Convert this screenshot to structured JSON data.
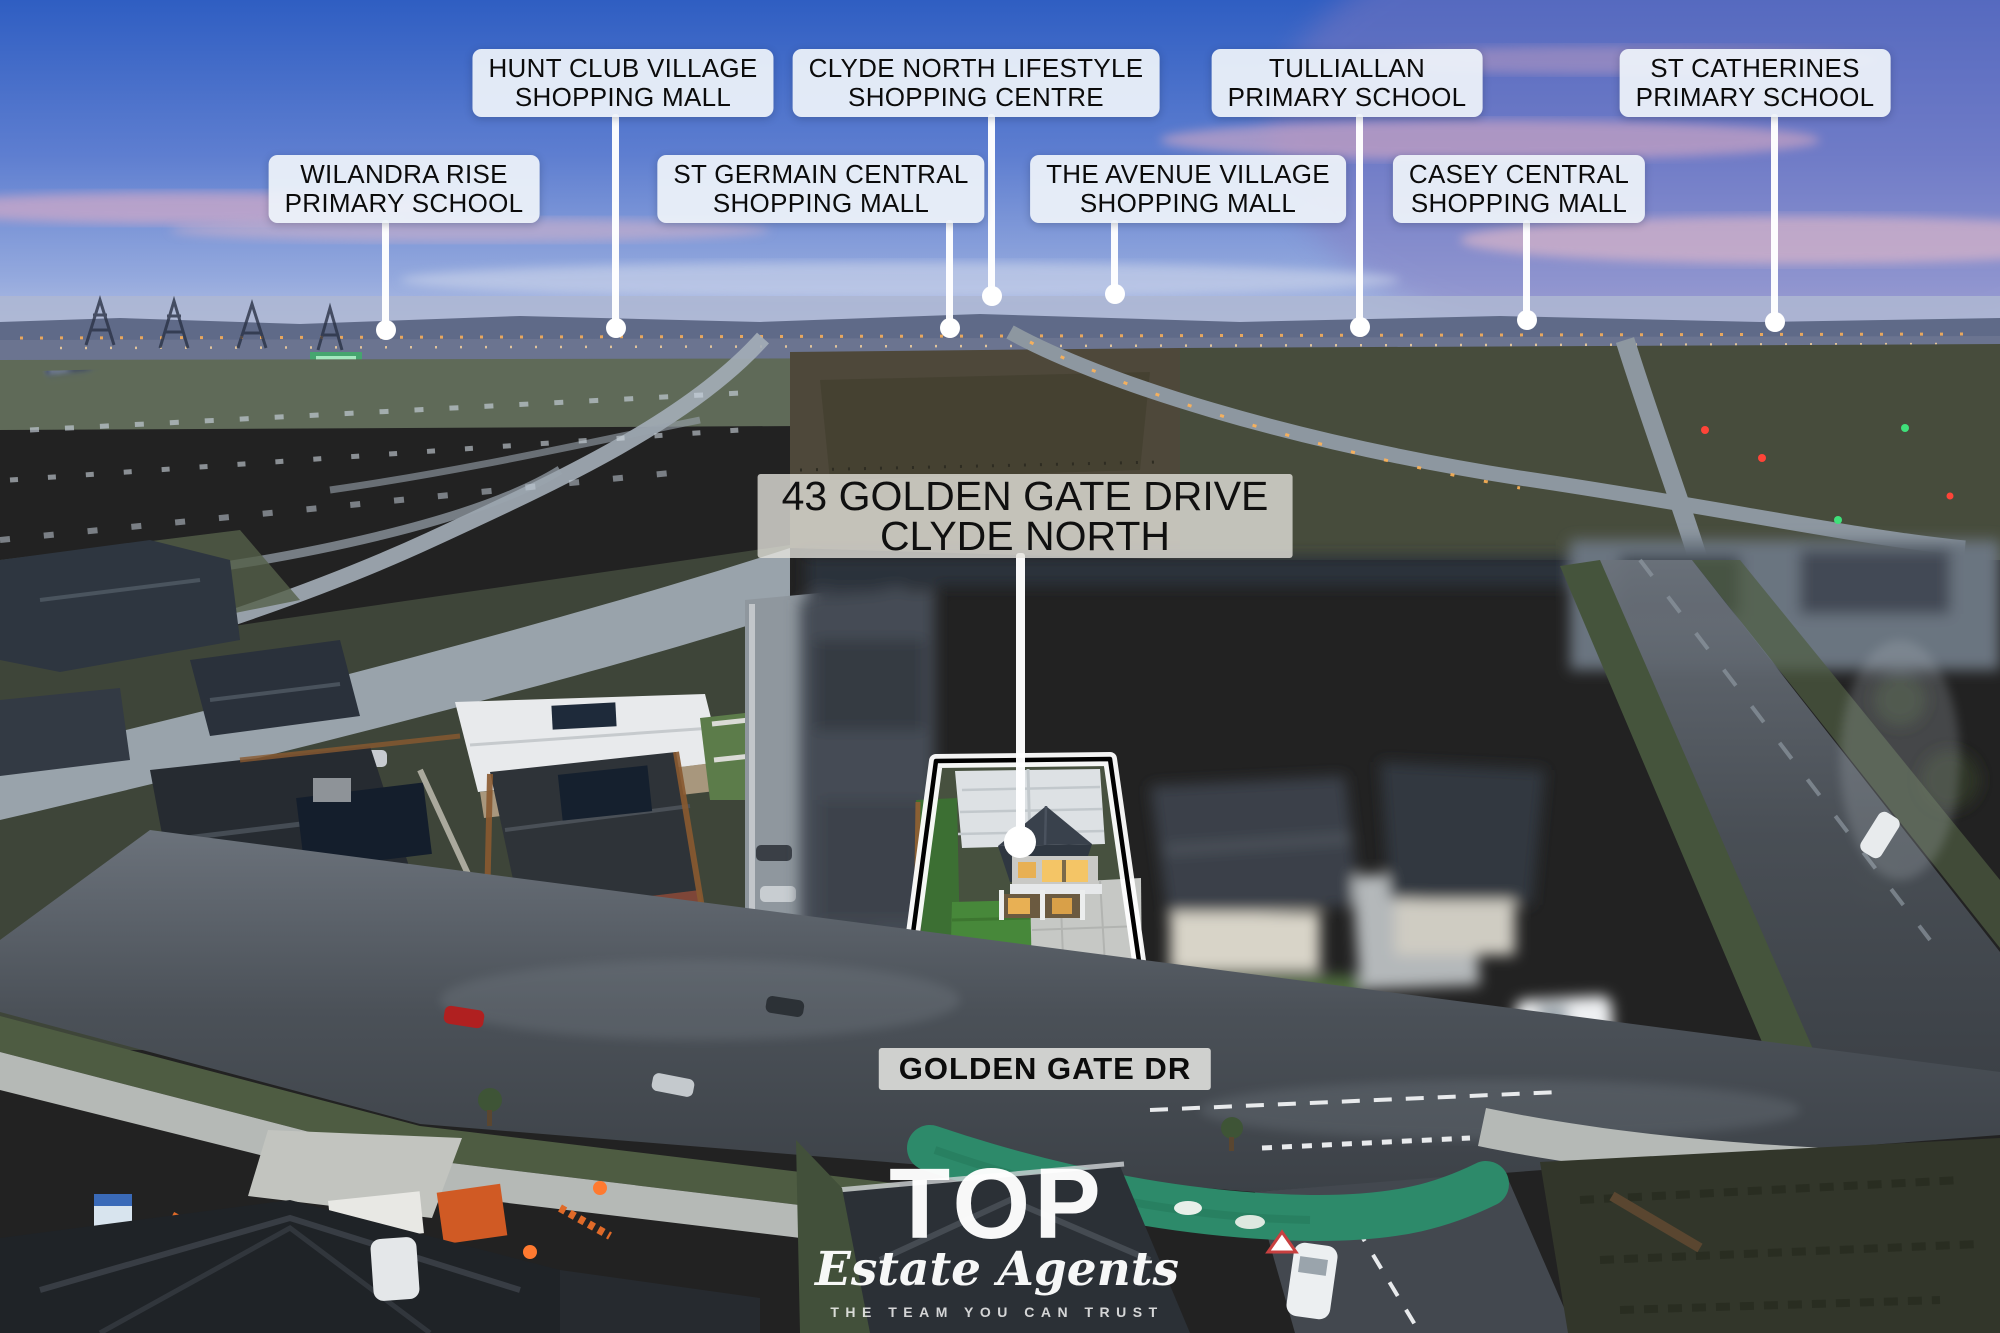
{
  "callouts": [
    {
      "name": "hunt-club-village",
      "line1": "HUNT CLUB VILLAGE",
      "line2": "SHOPPING MALL"
    },
    {
      "name": "clyde-north-lifestyle",
      "line1": "CLYDE NORTH LIFESTYLE",
      "line2": "SHOPPING CENTRE"
    },
    {
      "name": "tulliallan",
      "line1": "TULLIALLAN",
      "line2": "PRIMARY SCHOOL"
    },
    {
      "name": "st-catherines",
      "line1": "ST CATHERINES",
      "line2": "PRIMARY SCHOOL"
    },
    {
      "name": "wilandra-rise",
      "line1": "WILANDRA RISE",
      "line2": "PRIMARY SCHOOL"
    },
    {
      "name": "st-germain-central",
      "line1": "ST GERMAIN CENTRAL",
      "line2": "SHOPPING MALL"
    },
    {
      "name": "the-avenue-village",
      "line1": "THE AVENUE VILLAGE",
      "line2": "SHOPPING MALL"
    },
    {
      "name": "casey-central",
      "line1": "CASEY CENTRAL",
      "line2": "SHOPPING MALL"
    }
  ],
  "property_label": {
    "line1": "43 GOLDEN GATE DRIVE",
    "line2": "CLYDE NORTH"
  },
  "street_label": {
    "text": "GOLDEN GATE DR"
  },
  "logo": {
    "brand": "TOP",
    "script": "Estate Agents",
    "tagline": "THE TEAM YOU CAN TRUST"
  },
  "colors": {
    "label_bg": "#eef3fa",
    "label_text": "#0b0b0b",
    "leader_line": "#ffffff",
    "bike_path": "#2d8a6a",
    "lot_outline": "#000000",
    "lot_outline_glow": "#ffffff"
  }
}
